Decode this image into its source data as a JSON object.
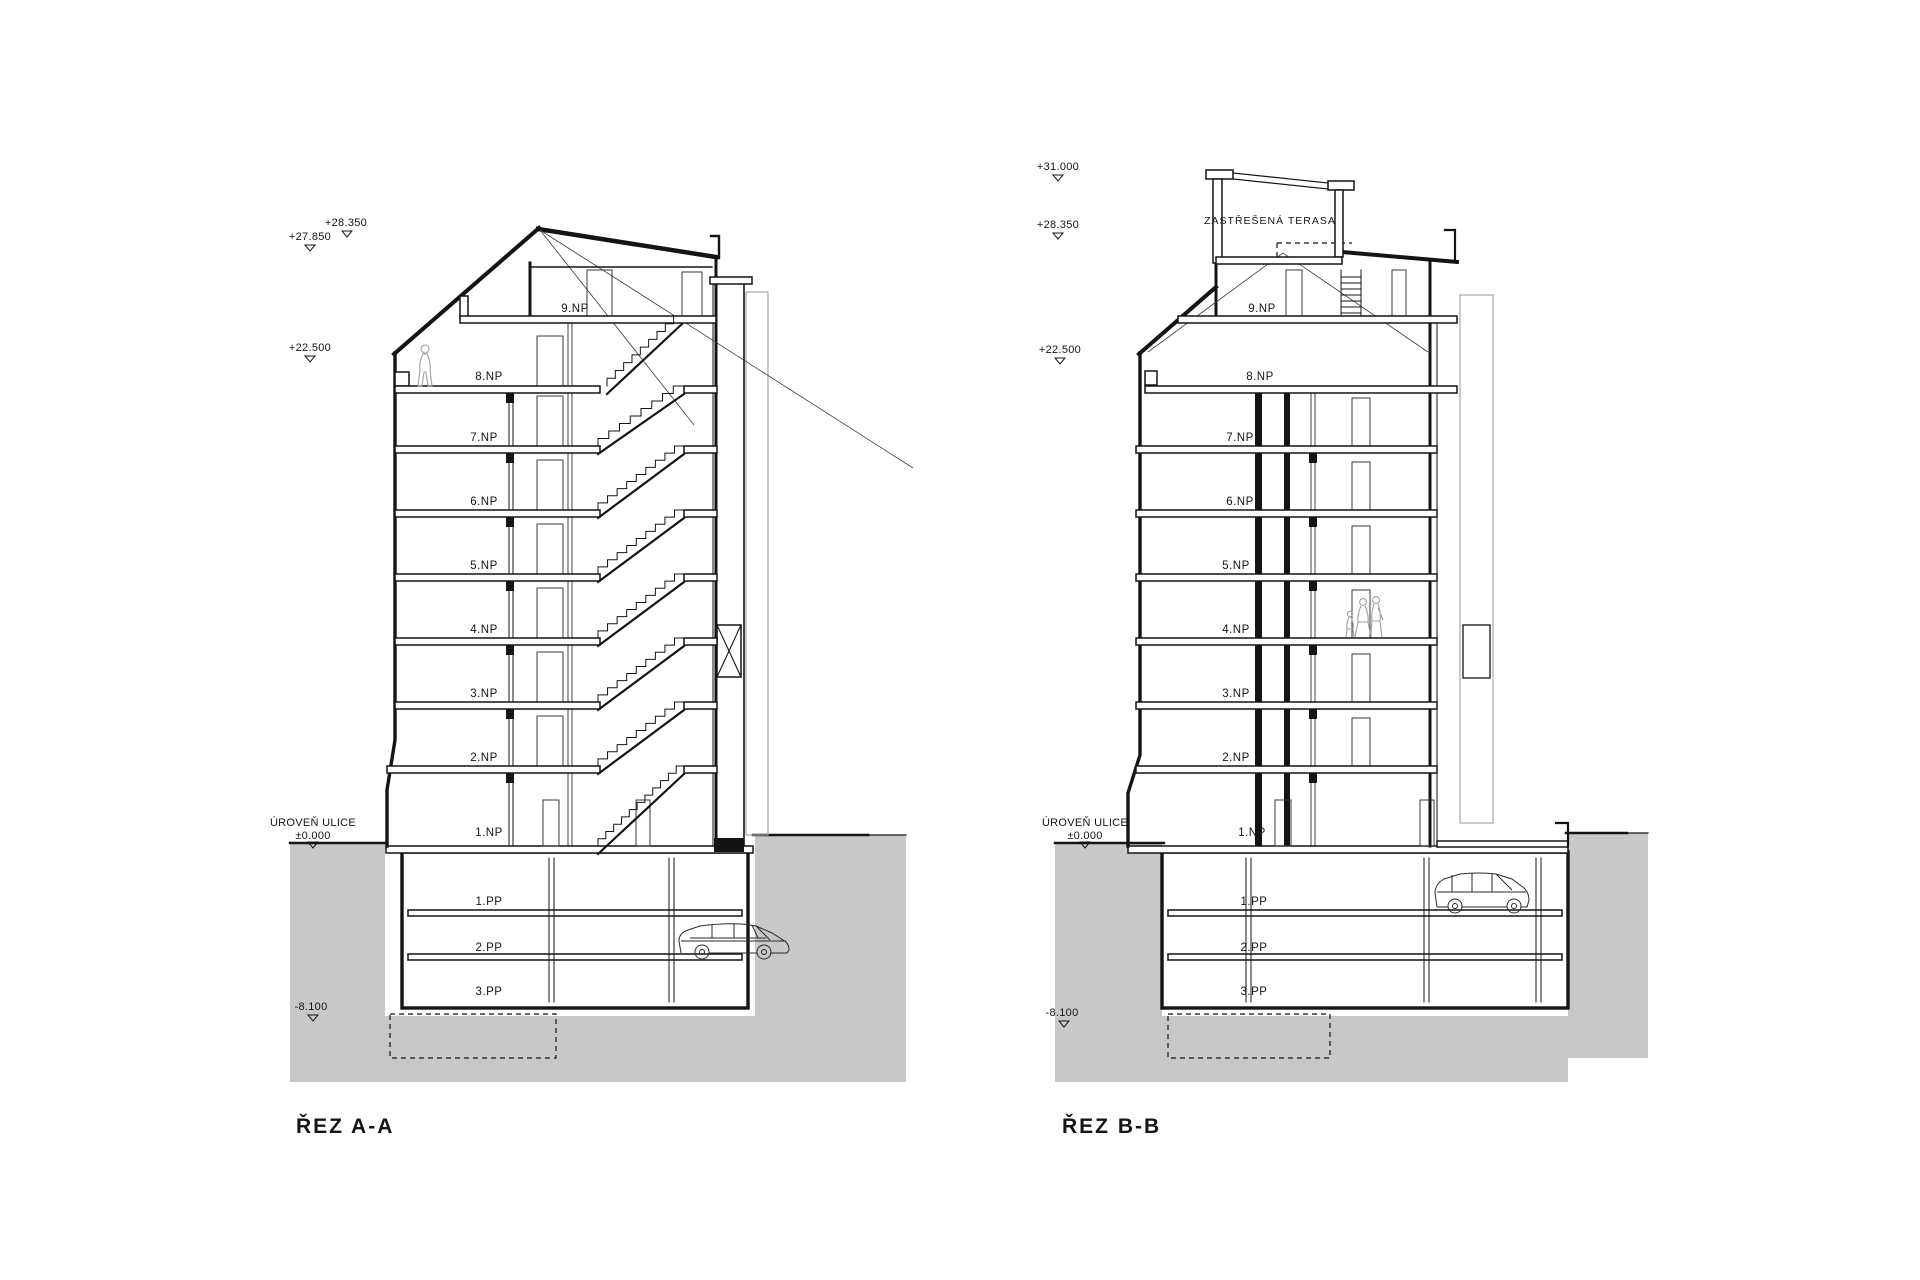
{
  "drawing": {
    "ink": "#141414",
    "ground_color": "#c8c8c8",
    "section_a": {
      "title": "ŘEZ A-A",
      "floors": [
        "9.NP",
        "8.NP",
        "7.NP",
        "6.NP",
        "5.NP",
        "4.NP",
        "3.NP",
        "2.NP",
        "1.NP"
      ],
      "basement_floors": [
        "1.PP",
        "2.PP",
        "3.PP"
      ],
      "elevations": {
        "roof_upper": "+28.350",
        "roof_lower": "+27.850",
        "mid": "+22.500",
        "base": "-8.100"
      },
      "street_line1": "ÚROVEŇ ULICE",
      "street_line2": "±0.000"
    },
    "section_b": {
      "title": "ŘEZ B-B",
      "terrace_label": "ZASTŘEŠENÁ TERASA",
      "floors": [
        "9.NP",
        "8.NP",
        "7.NP",
        "6.NP",
        "5.NP",
        "4.NP",
        "3.NP",
        "2.NP",
        "1.NP"
      ],
      "basement_floors": [
        "1.PP",
        "2.PP",
        "3.PP"
      ],
      "elevations": {
        "pergola": "+31.000",
        "roof": "+28.350",
        "mid": "+22.500",
        "base": "-8.100"
      },
      "street_line1": "ÚROVEŇ ULICE",
      "street_line2": "±0.000"
    }
  }
}
